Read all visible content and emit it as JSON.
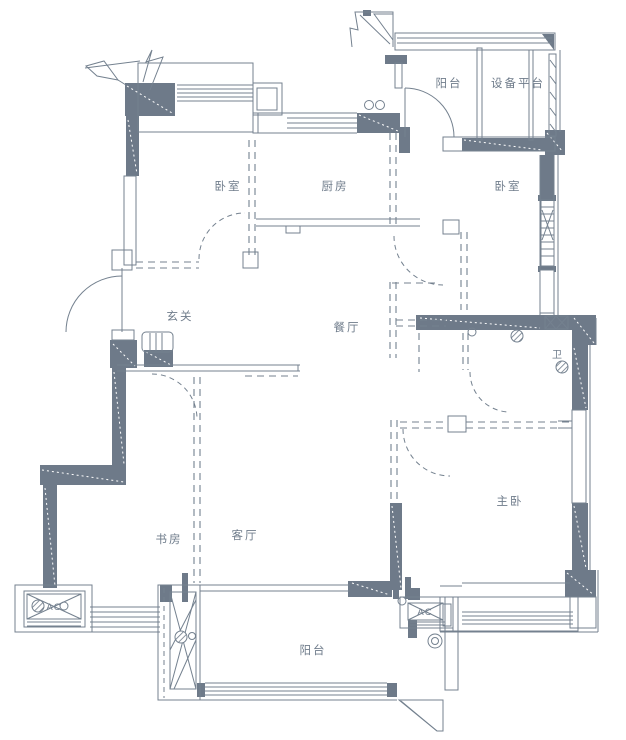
{
  "colors": {
    "wall": "#6e7a89",
    "line": "#74818f",
    "background": "#ffffff",
    "label": "#6f7c8b"
  },
  "rooms": [
    {
      "id": "bedroom-left",
      "label": "卧室"
    },
    {
      "id": "kitchen",
      "label": "厨房"
    },
    {
      "id": "balcony-top",
      "label": "阳台"
    },
    {
      "id": "equipment-platform",
      "label": "设备平台"
    },
    {
      "id": "bedroom-right",
      "label": "卧室"
    },
    {
      "id": "entry",
      "label": "玄关"
    },
    {
      "id": "dining",
      "label": "餐厅"
    },
    {
      "id": "bath",
      "label": "卫"
    },
    {
      "id": "study",
      "label": "书房"
    },
    {
      "id": "living",
      "label": "客厅"
    },
    {
      "id": "master-bedroom",
      "label": "主卧"
    },
    {
      "id": "balcony-bottom",
      "label": "阳台"
    }
  ],
  "units": [
    {
      "id": "ac-left",
      "label": "AC"
    },
    {
      "id": "ac-right",
      "label": "AC"
    }
  ]
}
